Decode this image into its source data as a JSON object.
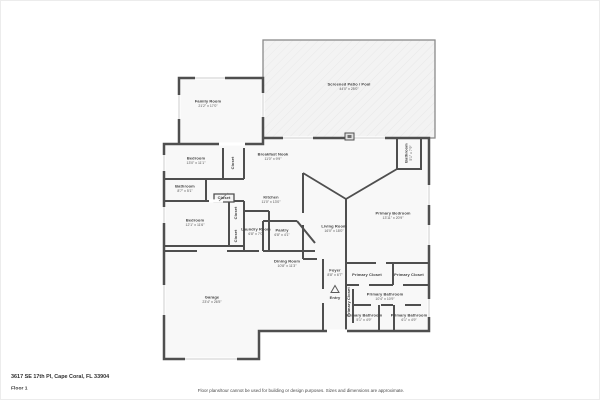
{
  "page": {
    "address": "3617 SE 17th Pl, Cape Coral, FL 33904",
    "floor_label": "Floor 1",
    "disclaimer": "Floor plans/tour cannot be used for building or design purposes. Sizes and dimensions are approximate."
  },
  "colors": {
    "wall": "#4f4f4f",
    "patio_wall": "#8a8a8a",
    "room_fill": "#f8f8f8",
    "patio_fill": "#f3f3f3",
    "label_text": "#3d3d3d"
  },
  "rooms": [
    {
      "id": "screened-patio",
      "name": "Screened Patio / Pool",
      "dims": "44'0\" x 25'0\"",
      "x": 348,
      "y": 86
    },
    {
      "id": "family-room",
      "name": "Family Room",
      "dims": "21'2\" x 17'0\"",
      "x": 207,
      "y": 103
    },
    {
      "id": "bedroom-1",
      "name": "Bedroom",
      "dims": "13'0\" x 11'1\"",
      "x": 195,
      "y": 160
    },
    {
      "id": "closet-1",
      "name": "Closet",
      "dims": "",
      "x": 232,
      "y": 162,
      "rot": 1
    },
    {
      "id": "bathroom-1",
      "name": "Bathroom",
      "dims": "8'7\" x 5'1\"",
      "x": 184,
      "y": 188
    },
    {
      "id": "bedroom-2",
      "name": "Bedroom",
      "dims": "12'1\" x 11'6\"",
      "x": 194,
      "y": 222
    },
    {
      "id": "closet-2",
      "name": "Closet",
      "dims": "",
      "x": 235,
      "y": 212,
      "rot": 1
    },
    {
      "id": "closet-3",
      "name": "Closet",
      "dims": "",
      "x": 235,
      "y": 235,
      "rot": 1
    },
    {
      "id": "closet-4",
      "name": "Closet",
      "dims": "",
      "x": 223,
      "y": 197
    },
    {
      "id": "laundry-room",
      "name": "Laundry Room",
      "dims": "6'8\" x 7'0\"",
      "x": 255,
      "y": 231
    },
    {
      "id": "breakfast-nook",
      "name": "Breakfast Nook",
      "dims": "11'0\" x 9'9\"",
      "x": 272,
      "y": 156
    },
    {
      "id": "kitchen",
      "name": "Kitchen",
      "dims": "11'0\" x 13'0\"",
      "x": 270,
      "y": 199
    },
    {
      "id": "pantry",
      "name": "Pantry",
      "dims": "6'8\" x 4'1\"",
      "x": 281,
      "y": 232
    },
    {
      "id": "dining-room",
      "name": "Dining Room",
      "dims": "10'8\" x 11'3\"",
      "x": 286,
      "y": 263
    },
    {
      "id": "living-room",
      "name": "Living Room",
      "dims": "16'0\" x 18'0\"",
      "x": 333,
      "y": 228
    },
    {
      "id": "foyer",
      "name": "Foyer",
      "dims": "8'8\" x 6'7\"",
      "x": 334,
      "y": 272
    },
    {
      "id": "entry",
      "name": "Entry",
      "dims": "",
      "x": 334,
      "y": 297
    },
    {
      "id": "pool-bathroom",
      "name": "Bathroom",
      "dims": "5'1\" x 7'9\"",
      "x": 408,
      "y": 152,
      "rot": 1
    },
    {
      "id": "primary-bedroom",
      "name": "Primary Bedroom",
      "dims": "13'11\" x 20'9\"",
      "x": 392,
      "y": 215
    },
    {
      "id": "primary-closet-1",
      "name": "Primary Closet",
      "dims": "",
      "x": 366,
      "y": 274
    },
    {
      "id": "primary-closet-2",
      "name": "Primary Closet",
      "dims": "",
      "x": 408,
      "y": 274
    },
    {
      "id": "primary-closet-3",
      "name": "Primary Closet",
      "dims": "",
      "x": 348,
      "y": 301,
      "rot": 1
    },
    {
      "id": "primary-bathroom",
      "name": "Primary Bathroom",
      "dims": "10'4\" x 10'9\"",
      "x": 384,
      "y": 296
    },
    {
      "id": "primary-bathroom-2",
      "name": "Primary Bathroom",
      "dims": "5'1\" x 4'9\"",
      "x": 363,
      "y": 317
    },
    {
      "id": "primary-bathroom-3",
      "name": "Primary Bathroom",
      "dims": "6'1\" x 4'9\"",
      "x": 408,
      "y": 317
    },
    {
      "id": "garage",
      "name": "Garage",
      "dims": "23'4\" x 26'5\"",
      "x": 211,
      "y": 299
    }
  ]
}
